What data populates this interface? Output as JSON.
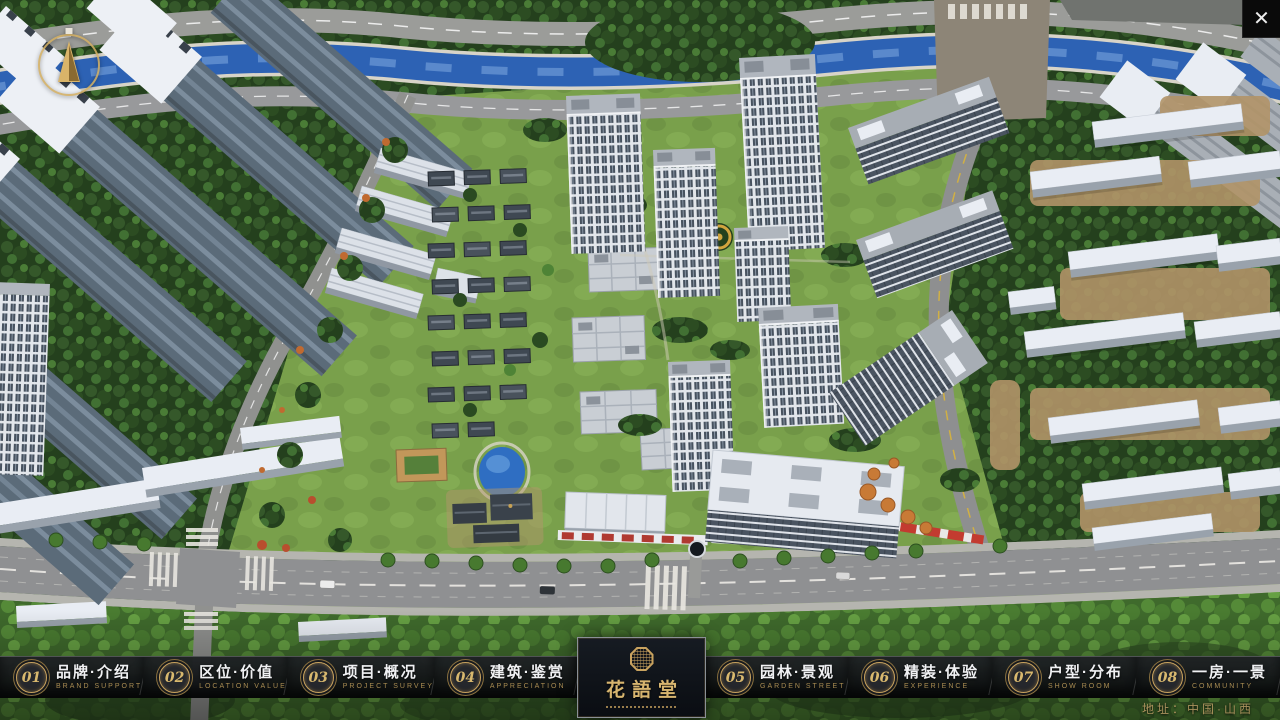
{
  "window": {
    "close_icon": "✕"
  },
  "nav": {
    "items": [
      {
        "num": "01",
        "zh": "品牌·介绍",
        "en": "BRAND SUPPORT"
      },
      {
        "num": "02",
        "zh": "区位·价值",
        "en": "LOCATION VALUE"
      },
      {
        "num": "03",
        "zh": "项目·概况",
        "en": "PROJECT SURVEY"
      },
      {
        "num": "04",
        "zh": "建筑·鉴赏",
        "en": "APPRECIATION"
      },
      {
        "num": "05",
        "zh": "园林·景观",
        "en": "GARDEN STREET"
      },
      {
        "num": "06",
        "zh": "精装·体验",
        "en": "EXPERIENCE"
      },
      {
        "num": "07",
        "zh": "户型·分布",
        "en": "SHOW ROOM"
      },
      {
        "num": "08",
        "zh": "一房·一景",
        "en": "COMMUNITY"
      }
    ]
  },
  "logo": {
    "title": "花語堂"
  },
  "footer": {
    "address": "地址：中国·山西"
  },
  "colors": {
    "gold": "#c9a35f",
    "nav_bg": "#101214",
    "river": "#2d62b4",
    "lawn": "#79a04b",
    "tree_dark": "#24401d",
    "road": "#8f9092"
  }
}
